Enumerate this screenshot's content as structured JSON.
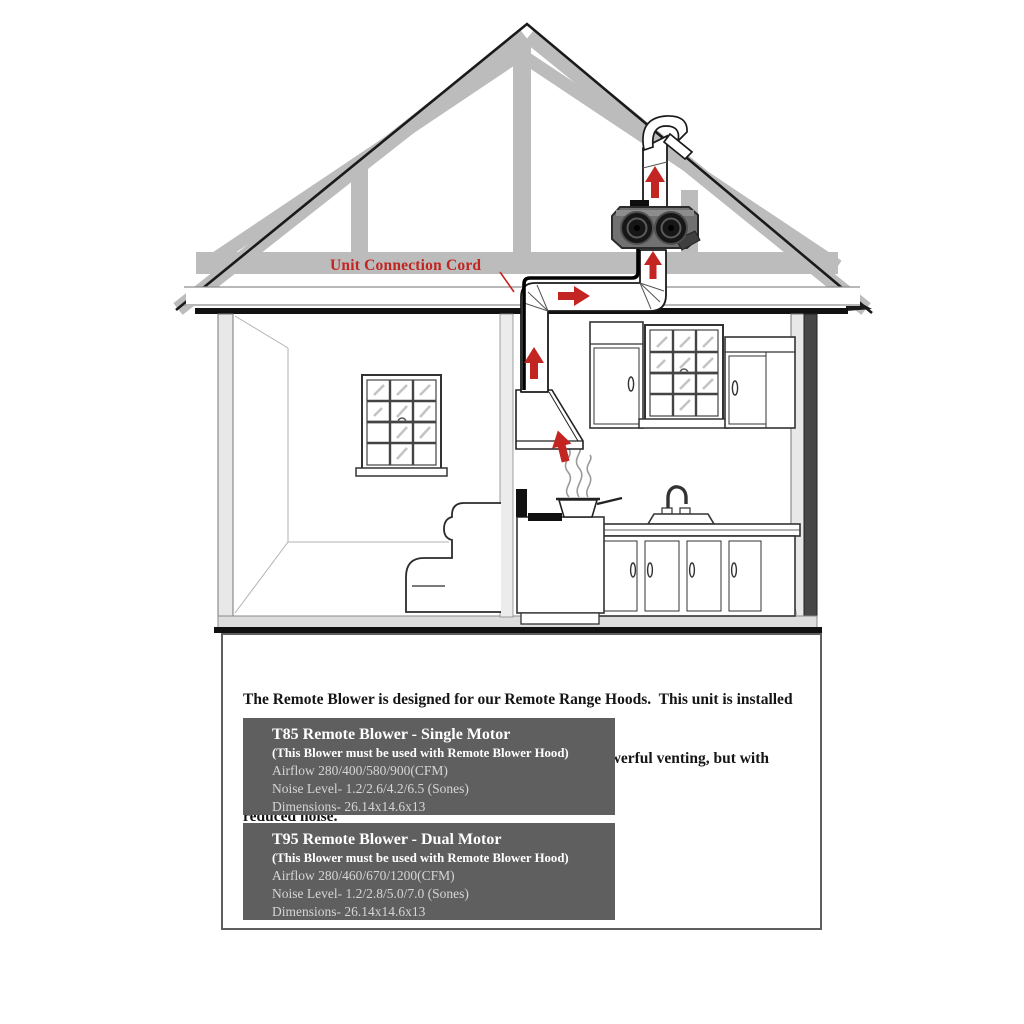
{
  "annotation": {
    "unit_connection_cord": "Unit Connection Cord"
  },
  "description": {
    "line1": "The Remote Blower is designed for our Remote Range Hoods.  This unit is installed",
    "line2": "remotely in the interior of your home.  This provides powerful venting, but with",
    "line3": "reduced noise."
  },
  "products": [
    {
      "title": "T85 Remote Blower - Single Motor",
      "note": "(This Blower must be used with Remote Blower Hood)",
      "airflow": "Airflow 280/400/580/900(CFM)",
      "noise_level": "Noise Level- 1.2/2.6/4.2/6.5 (Sones)",
      "dimensions": "Dimensions- 26.14x14.6x13"
    },
    {
      "title": "T95 Remote Blower - Dual Motor",
      "note": "(This Blower must be used with Remote Blower Hood)",
      "airflow": "Airflow 280/460/670/1200(CFM)",
      "noise_level": "Noise Level- 1.2/2.8/5.0/7.0 (Sones)",
      "dimensions": "Dimensions- 26.14x14.6x13"
    }
  ],
  "colors": {
    "accent_red": "#c32622",
    "panel_gray": "#5f5f5f",
    "truss_gray": "#bcbcbc",
    "wall_gray": "#e8e8e8",
    "spec_text": "#d6d6d6",
    "line_black": "#1a1a1a"
  },
  "icons": {
    "airflow_arrow_up": "↑",
    "airflow_arrow_right": "→"
  }
}
